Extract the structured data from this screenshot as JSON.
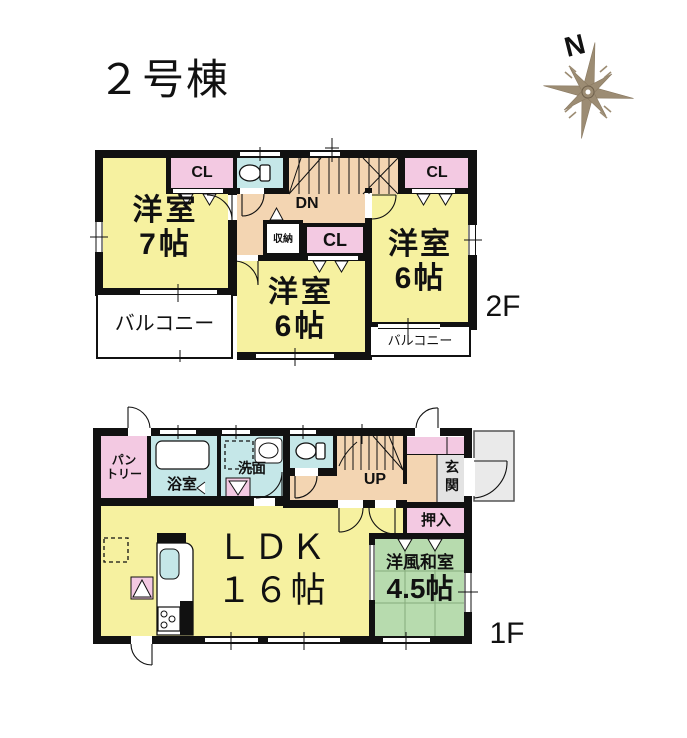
{
  "title": "２号棟",
  "compass": {
    "north_label": "N"
  },
  "palette": {
    "room_yellow": "#F6F1A0",
    "closet_pink": "#F3C9E2",
    "wet_cyan": "#C5E7E8",
    "hall_peach": "#F3D5B2",
    "tatami_green": "#B7DBAE",
    "entry_gray": "#E3E3E3",
    "porch_gray": "#EAEAEA",
    "wall_black": "#111111",
    "compass_brown": "#9C8C73"
  },
  "floors": {
    "f2": {
      "floor_label": "2F",
      "stairs_label": "DN",
      "rooms": [
        {
          "label": "洋室",
          "size": "7帖"
        },
        {
          "label": "洋室",
          "size": "6帖"
        },
        {
          "label": "洋室",
          "size": "6帖"
        }
      ],
      "closets": {
        "left": "CL",
        "middle": "CL",
        "right": "CL",
        "storage": "収納"
      },
      "balconies": [
        {
          "label": "バルコニー"
        },
        {
          "label": "バルコニー"
        }
      ]
    },
    "f1": {
      "floor_label": "1F",
      "stairs_label": "UP",
      "pantry": {
        "line1": "パン",
        "line2": "トリー"
      },
      "bathroom": "浴室",
      "washroom": "洗面",
      "entrance": {
        "line1": "玄",
        "line2": "関"
      },
      "closet": "押入",
      "ldk": {
        "name": "ＬＤＫ",
        "size": "１６帖"
      },
      "japanese_room": {
        "name": "洋風和室",
        "size": "4.5帖"
      }
    }
  }
}
